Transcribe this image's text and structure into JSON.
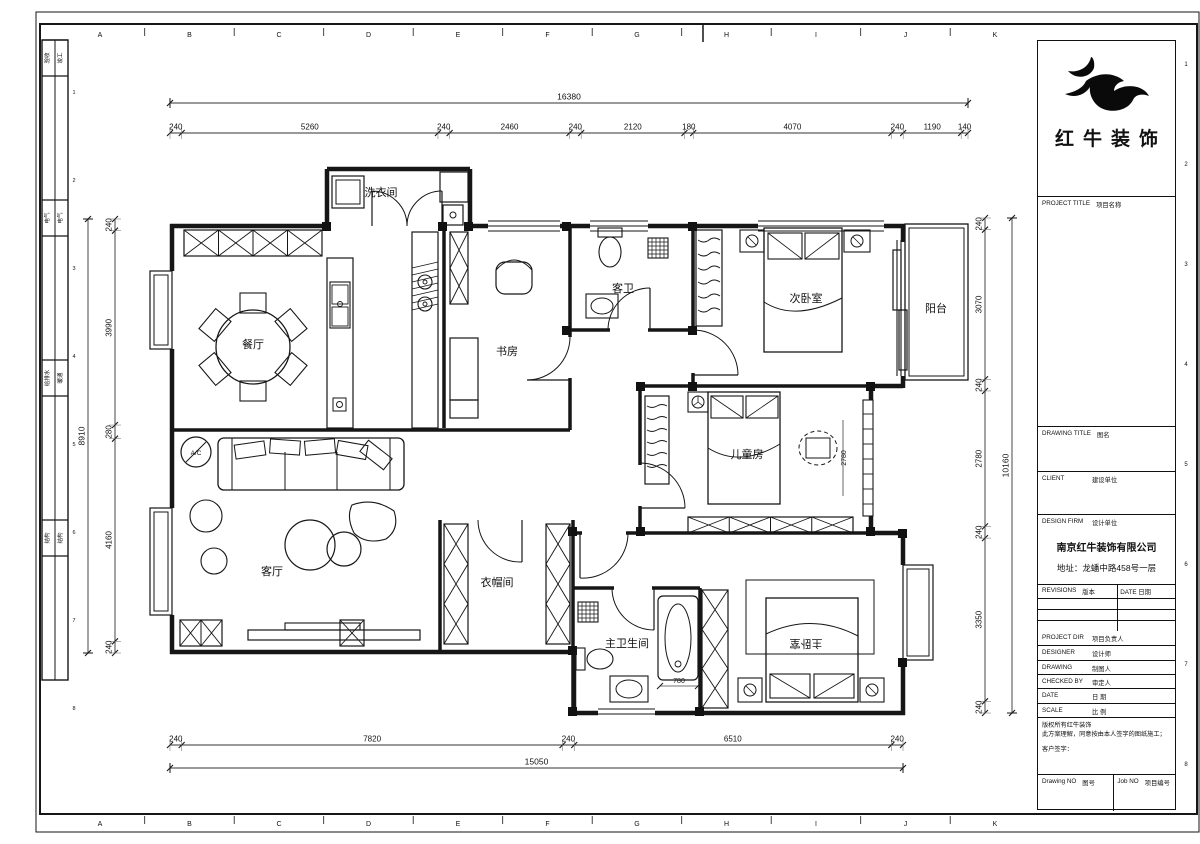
{
  "sheet": {
    "grid_letters": [
      "A",
      "B",
      "C",
      "D",
      "E",
      "F",
      "G",
      "H",
      "I",
      "J",
      "K"
    ],
    "grid_numbers": [
      "1",
      "2",
      "3",
      "4",
      "5",
      "6",
      "7",
      "8"
    ],
    "signoff_rows": [
      [
        "验收",
        "竣工"
      ],
      [
        "电气",
        "电气"
      ],
      [
        "给排水",
        "暖通"
      ],
      [
        "结构",
        "结构"
      ]
    ]
  },
  "plan": {
    "rooms": [
      "洗衣间",
      "餐厅",
      "书房",
      "客卫",
      "次卧室",
      "阳台",
      "儿童房",
      "客厅",
      "衣帽间",
      "主卫生间",
      "主卧室"
    ],
    "ac_label": "A/C",
    "inline_dims": [
      "2780",
      "780"
    ]
  },
  "dims": {
    "top": {
      "total": "16380",
      "segments": [
        "240",
        "5260",
        "240",
        "2460",
        "240",
        "2120",
        "180",
        "4070",
        "240",
        "1190",
        "140"
      ]
    },
    "left": {
      "total": "8910",
      "segments": [
        "240",
        "3990",
        "280",
        "4160",
        "240"
      ]
    },
    "right": {
      "total": "10160",
      "segments": [
        "240",
        "3070",
        "240",
        "2780",
        "240",
        "3350",
        "240"
      ]
    },
    "bottom": {
      "total": "15050",
      "segments": [
        "240",
        "7820",
        "240",
        "6510",
        "240"
      ]
    }
  },
  "titleblock": {
    "logo_name": "红牛装饰",
    "project_title_en": "PROJECT TITLE",
    "project_title_zh": "项目名称",
    "drawing_title_en": "DRAWING TITLE",
    "drawing_title_zh": "图名",
    "client_en": "CLIENT",
    "client_zh": "建设单位",
    "design_firm_en": "DESIGN FIRM",
    "design_firm_zh": "设计单位",
    "company": "南京红牛装饰有限公司",
    "address": "地址：龙蟠中路458号一层",
    "revisions_en": "REVISIONS",
    "revisions_zh": "版本",
    "date_head_en": "DATE",
    "date_head_zh": "日期",
    "project_dir_en": "PROJECT DIR",
    "project_dir_zh": "项目负责人",
    "designer_en": "DESIGNER",
    "designer_zh": "设计师",
    "drawing_en": "DRAWING",
    "drawing_zh": "制图人",
    "checked_en": "CHECKED BY",
    "checked_zh": "审定人",
    "date_en": "DATE",
    "date_zh": "日 期",
    "scale_en": "SCALE",
    "scale_zh": "比 例",
    "copyright_1": "版权所有红牛装饰",
    "copyright_2": "此方案理解，同意按由本人签字的图纸施工；",
    "copyright_3": "客户签字：",
    "drawing_no_en": "Drawing NO",
    "drawing_no_zh": "图号",
    "job_no_en": "Job NO",
    "job_no_zh": "项目编号"
  }
}
